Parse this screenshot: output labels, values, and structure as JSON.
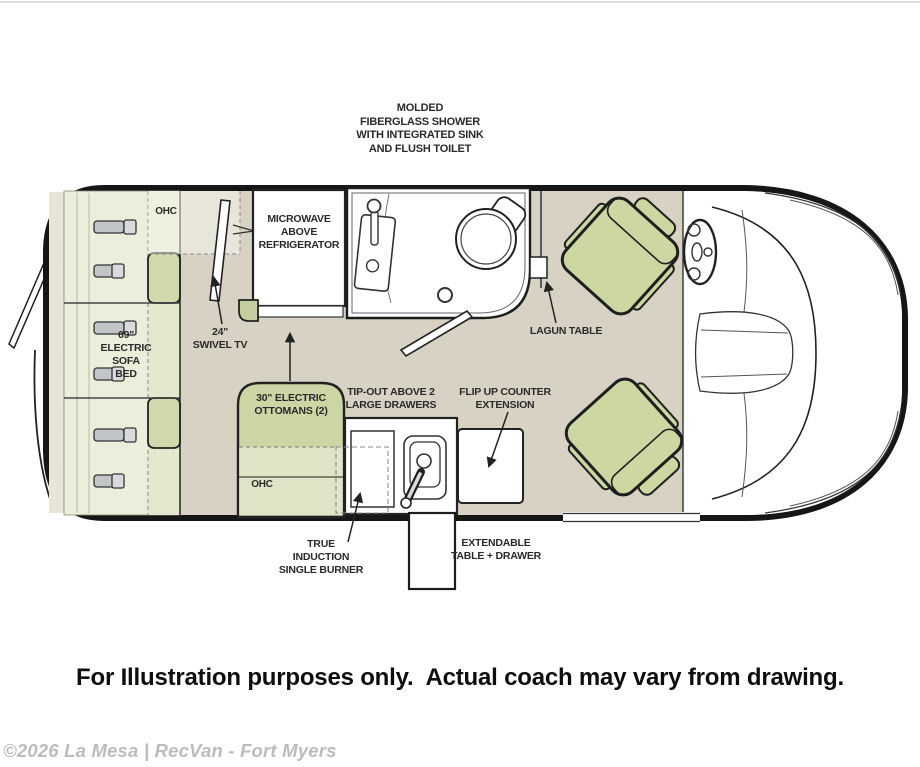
{
  "diagram": {
    "type": "rv-floorplan",
    "shower_note": "MOLDED\nFIBERGLASS SHOWER\nWITH INTEGRATED SINK\nAND FLUSH TOILET",
    "labels": {
      "ohc_top": "OHC",
      "microwave": "MICROWAVE\nABOVE\nREFRIGERATOR",
      "swivel_tv": "24\"\nSWIVEL TV",
      "sofa_bed": "69\"\nELECTRIC\nSOFA\nBED",
      "lagun_table": "LAGUN TABLE",
      "ottomans": "30\" ELECTRIC\nOTTOMANS (2)",
      "tip_out": "TIP-OUT ABOVE 2\nLARGE DRAWERS",
      "flip_up": "FLIP UP COUNTER\nEXTENSION",
      "ohc_bottom": "OHC",
      "induction": "TRUE\nINDUCTION\nSINGLE BURNER",
      "extendable": "EXTENDABLE\nTABLE + DRAWER"
    },
    "colors": {
      "floor": "#d7d2c4",
      "cushion_light": "#eaeeda",
      "cushion_mid": "#e3e9cf",
      "cushion_dark": "#cfd9ab",
      "seat_green": "#cdd7a2",
      "ottoman_green": "#ccd6a4",
      "outline": "#1a1a1a",
      "watermark_gray": "#bcbcbc"
    }
  },
  "footer": {
    "disclaimer": "For Illustration purposes only.  Actual coach may vary from drawing."
  },
  "watermark": "©2026 La Mesa | RecVan - Fort Myers"
}
